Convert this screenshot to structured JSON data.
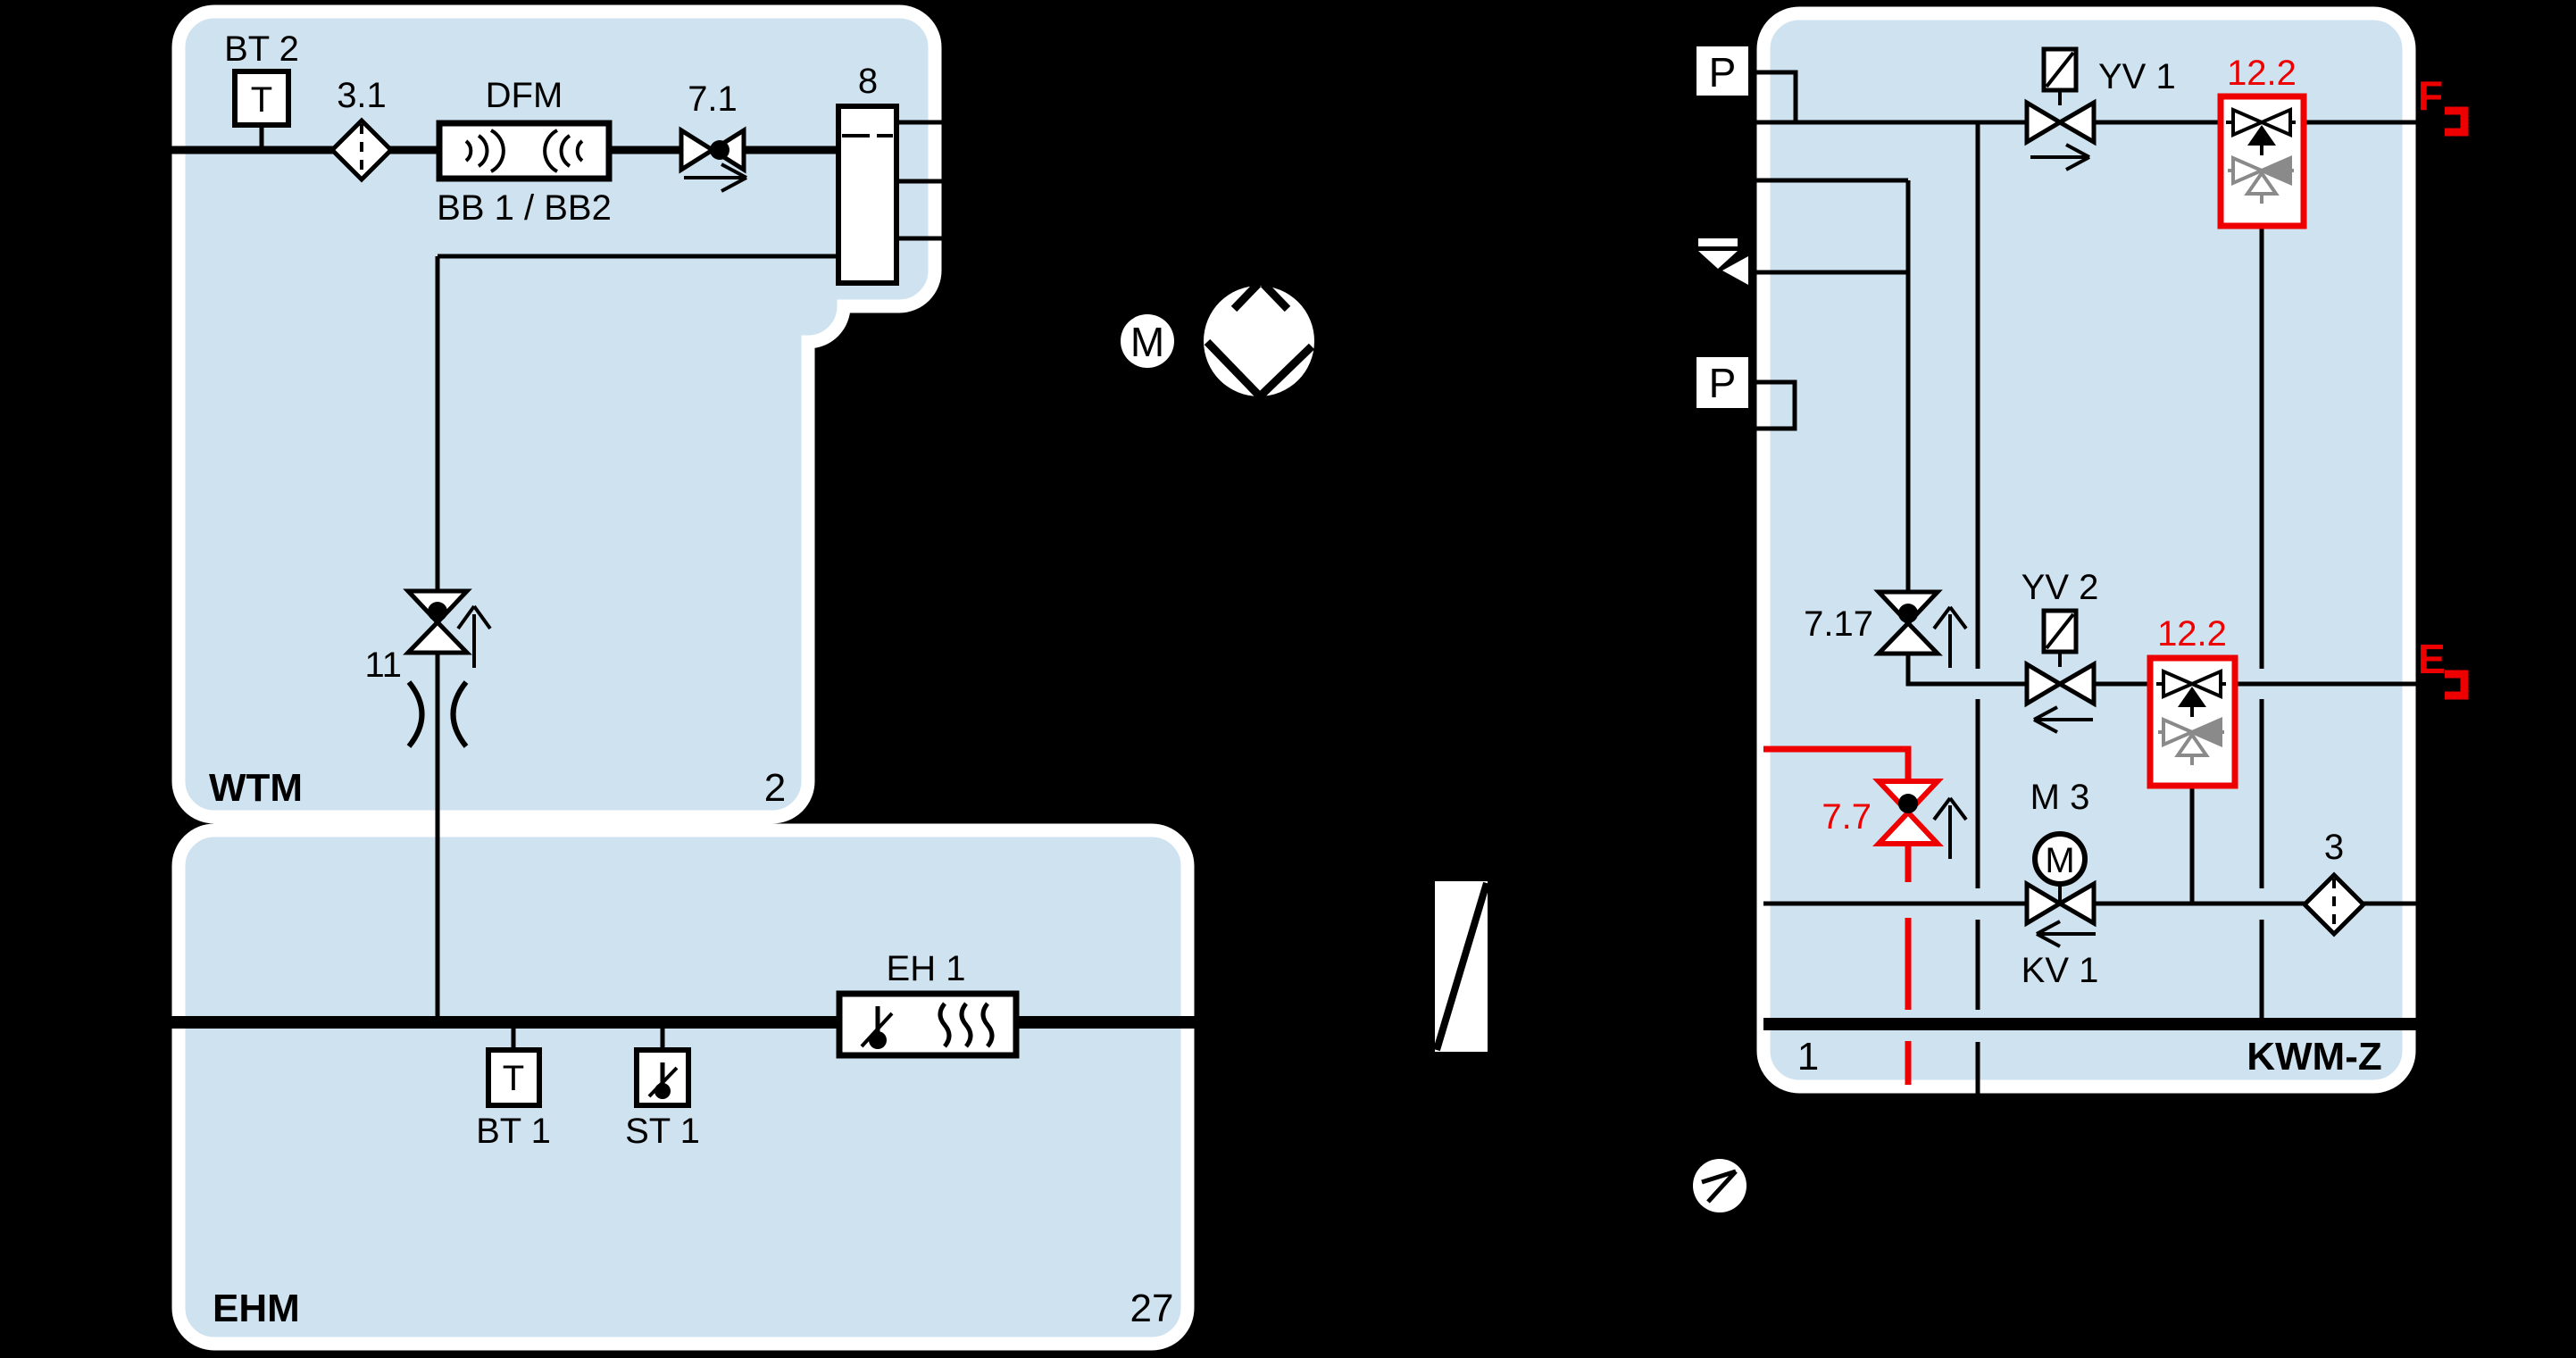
{
  "diagram": {
    "type": "piping-instrumentation-schematic",
    "colors": {
      "background": "#000000",
      "block_fill": "#cfe2f0",
      "block_border": "#ffffff",
      "line": "#000000",
      "highlight_red": "#ee0000",
      "secondary_gray": "#8a8a8a"
    },
    "blocks": {
      "wtm": {
        "name": "WTM",
        "number": "2"
      },
      "ehm": {
        "name": "EHM",
        "number": "27"
      },
      "kwmz": {
        "name": "KWM-Z",
        "number": "1"
      }
    },
    "labels": {
      "bt2": "BT 2",
      "bt2_glyph": "T",
      "filter31": "3.1",
      "dfm": "DFM",
      "dfm_sub": "BB 1 / BB2",
      "v71": "7.1",
      "vessel8": "8",
      "v11": "11",
      "bt1": "BT 1",
      "bt1_glyph": "T",
      "st1": "ST 1",
      "eh1": "EH 1",
      "p_top": "P",
      "p_mid": "P",
      "yv1": "YV 1",
      "yv2": "YV 2",
      "ref122_top": "12.2",
      "ref122_mid": "12.2",
      "v717": "7.17",
      "v77": "7.7",
      "m3": "M 3",
      "m3_glyph": "M",
      "kv1": "KV 1",
      "filter3": "3",
      "motor_glyph": "M",
      "ref_f": "F",
      "ref_e": "E"
    }
  }
}
